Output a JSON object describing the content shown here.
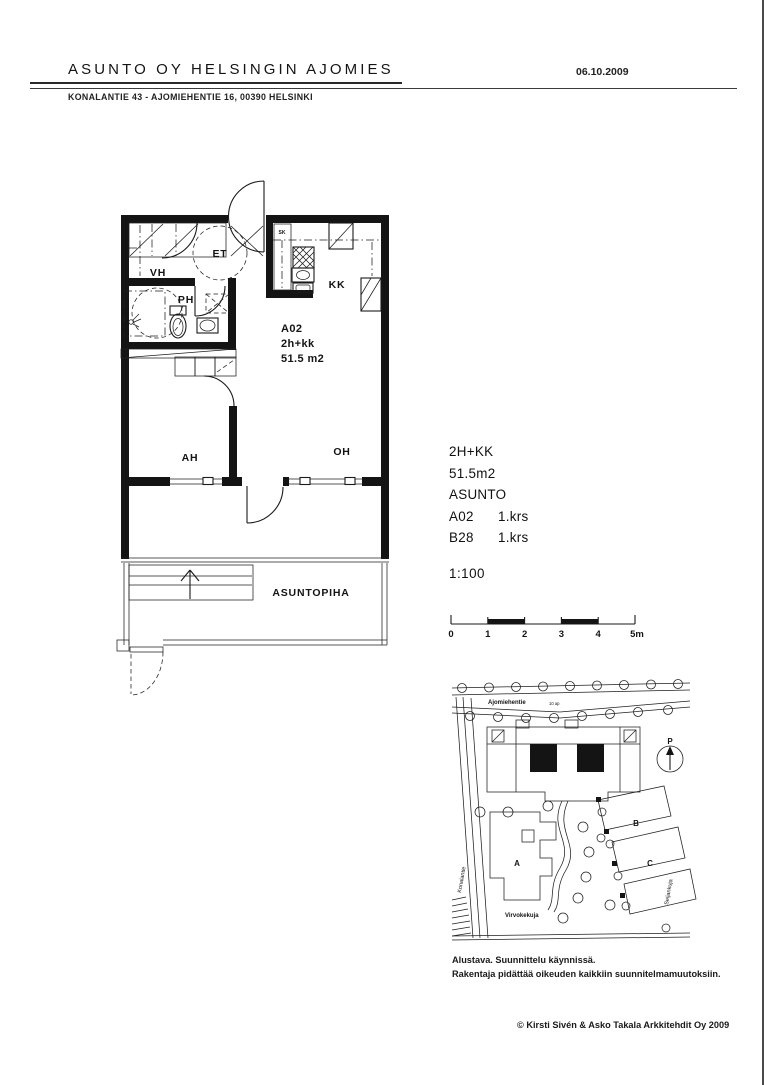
{
  "header": {
    "title": "ASUNTO OY HELSINGIN AJOMIES",
    "date": "06.10.2009",
    "address": "KONALANTIE 43 - AJOMIEHENTIE 16, 00390 HELSINKI"
  },
  "plan": {
    "rooms": {
      "et": "ET",
      "vh": "VH",
      "ph": "PH",
      "sk": "SK",
      "kk": "KK",
      "ah": "AH",
      "oh": "OH",
      "yard": "ASUNTOPIHA"
    },
    "unit": {
      "id": "A02",
      "type": "2h+kk",
      "area": "51.5 m2"
    }
  },
  "info": {
    "type": "2H+KK",
    "area": "51.5m2",
    "heading": "ASUNTO",
    "units": [
      {
        "id": "A02",
        "floor": "1.krs"
      },
      {
        "id": "B28",
        "floor": "1.krs"
      }
    ],
    "scale": "1:100",
    "scalebar": {
      "ticks": [
        "0",
        "1",
        "2",
        "3",
        "4",
        "5m"
      ]
    }
  },
  "siteplan": {
    "streets": {
      "top": "Ajomiehentie",
      "left": "Konalantie",
      "bottom": "Virvokekuja",
      "right": "Seljankuja"
    },
    "parking": "10 ap",
    "buildings": [
      "A",
      "B",
      "C"
    ],
    "north": "P"
  },
  "footer": {
    "note1": "Alustava. Suunnittelu käynnissä.",
    "note2": "Rakentaja pidättää oikeuden kaikkiin suunnitelmamuutoksiin.",
    "copyright": "© Kirsti Sivén & Asko Takala Arkkitehdit Oy 2009"
  },
  "colors": {
    "ink": "#1a1a1a",
    "paper": "#ffffff"
  }
}
